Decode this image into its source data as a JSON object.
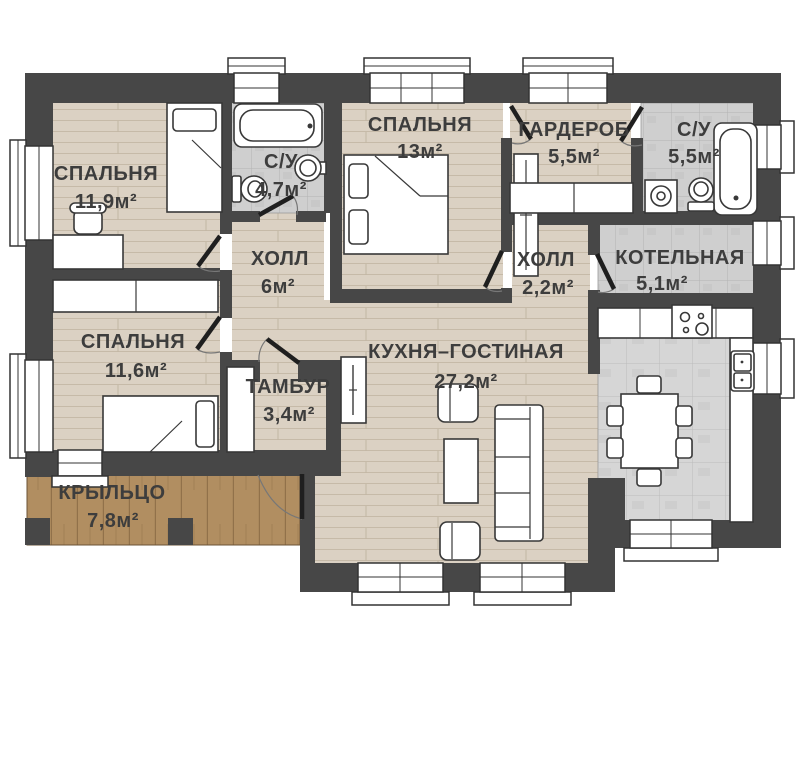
{
  "title": "План одноэтажного дома",
  "colors": {
    "wall": "#474747",
    "wood_floor": "#dbd1c3",
    "tile_floor": "#d2d2d2",
    "porch_wood": "#b18e61",
    "furniture": "#ffffff",
    "label_text": "#3d3d3d"
  },
  "rooms": [
    {
      "name": "СПАЛЬНЯ",
      "area": "11,9м²"
    },
    {
      "name": "С/У",
      "area": "4,7м²"
    },
    {
      "name": "СПАЛЬНЯ",
      "area": "13м²"
    },
    {
      "name": "ГАРДЕРОБ",
      "area": "5,5м²"
    },
    {
      "name": "С/У",
      "area": "5,5м²"
    },
    {
      "name": "ХОЛЛ",
      "area": "6м²"
    },
    {
      "name": "ХОЛЛ",
      "area": "2,2м²"
    },
    {
      "name": "КОТЕЛЬНАЯ",
      "area": "5,1м²"
    },
    {
      "name": "СПАЛЬНЯ",
      "area": "11,6м²"
    },
    {
      "name": "ТАМБУР",
      "area": "3,4м²"
    },
    {
      "name": "КУХНЯ–ГОСТИНАЯ",
      "area": "27,2м²"
    },
    {
      "name": "КРЫЛЬЦО",
      "area": "7,8м²"
    }
  ]
}
